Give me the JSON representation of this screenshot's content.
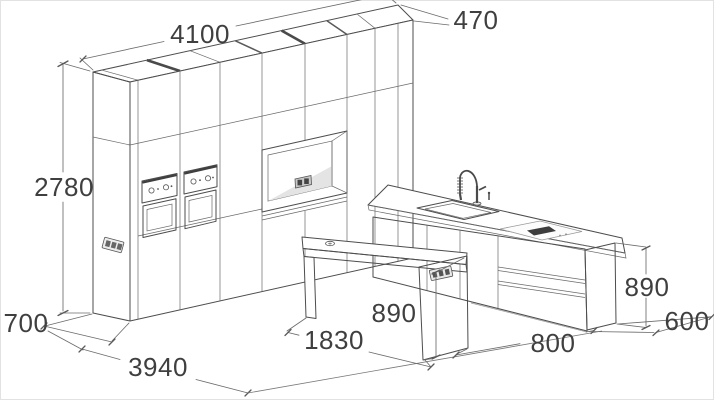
{
  "drawing": {
    "title": "kitchen-layout-dimensioned-drawing",
    "labels": {
      "cabinet_run_length": "4100",
      "cabinet_depth_top": "470",
      "cabinet_height": "2780",
      "cabinet_base_depth": "700",
      "floor_depth_total": "3940",
      "table_length": "1830",
      "table_height": "890",
      "aisle_width": "800",
      "island_height": "890",
      "island_end_width": "600"
    },
    "colors": {
      "background": "#ffffff",
      "line": "#4d4d4d",
      "text": "#3f3f3f",
      "niche_shade": "#d7d7d7",
      "panel_shade": "#f1f1f1",
      "vent_dark": "#3d3d3d"
    }
  }
}
